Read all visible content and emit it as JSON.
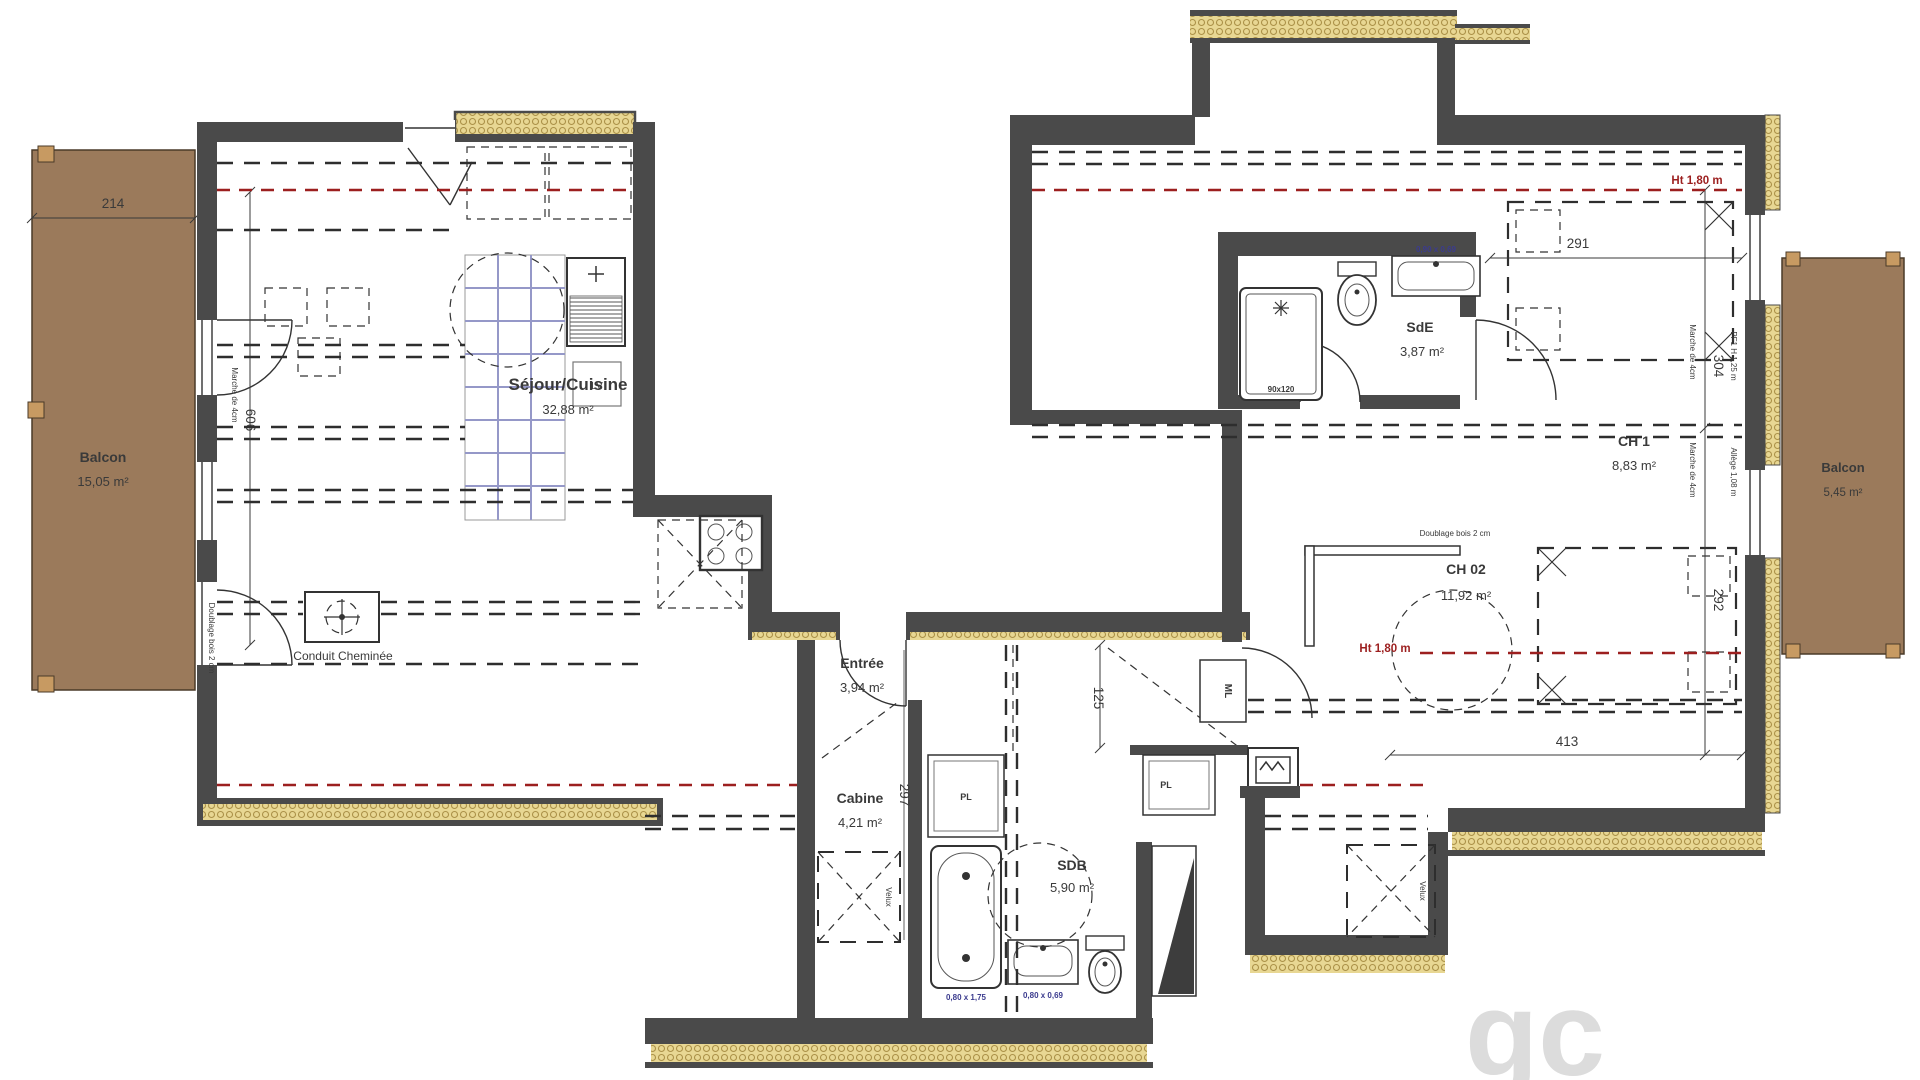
{
  "plan": {
    "title": "Plan d'appartement (niveau combles)",
    "rooms": {
      "balcon_left": {
        "name": "Balcon",
        "area": "15,05 m²"
      },
      "sejour": {
        "name": "Séjour/Cuisine",
        "area": "32,88 m²"
      },
      "entree": {
        "name": "Entrée",
        "area": "3,94 m²"
      },
      "cabine": {
        "name": "Cabine",
        "area": "4,21 m²"
      },
      "sdb": {
        "name": "SDB",
        "area": "5,90 m²"
      },
      "sde": {
        "name": "SdE",
        "area": "3,87 m²"
      },
      "ch1": {
        "name": "CH 1",
        "area": "8,83 m²"
      },
      "ch02": {
        "name": "CH 02",
        "area": "11,92 m²"
      },
      "balcon_right": {
        "name": "Balcon",
        "area": "5,45 m²"
      }
    },
    "dimensions": {
      "balcony_width": "214",
      "sejour_height": "606",
      "ch1_width": "291",
      "ch1_depth": "304",
      "ch02_depth": "292",
      "ch02_width": "413",
      "corridor": "125",
      "cabine_depth": "297"
    },
    "annotations": {
      "chimney": "Conduit Cheminée",
      "height_line": "Ht 1,80 m",
      "doublage": "Doublage bois 2 cm",
      "marche": "Marche de 4cm",
      "pf1": "PF1 H 1,25 m",
      "allege": "Allège 1,08 m",
      "velux": "Velux",
      "lv": "LV",
      "pl": "PL",
      "ml": "ML",
      "shower_size": "90x120",
      "basin_size": "0,90 x 0,69",
      "bath_size": "0,80 x 1,75",
      "sdb_basin_size": "0,80 x 0,69",
      "watermark": "gc"
    },
    "colors": {
      "wall": "#4a4a4a",
      "insulation": "#e8d793",
      "insulation_stroke": "#ab9148",
      "balcony": "#9b7a5b",
      "red_line": "#9c1f1f",
      "blue_label": "#3b3b8e",
      "kitchen_grid": "#9598c8"
    }
  }
}
